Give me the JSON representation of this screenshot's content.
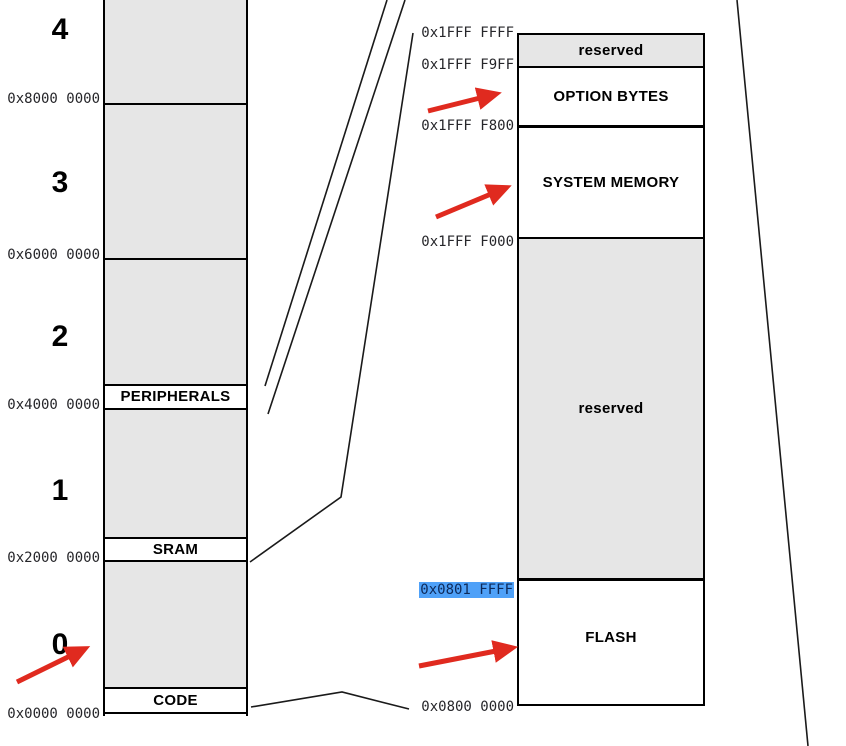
{
  "diagram": "microcontroller-memory-map",
  "left_map": {
    "region_numbers": [
      "4",
      "3",
      "2",
      "1",
      "0"
    ],
    "band_labels": {
      "peripherals": "PERIPHERALS",
      "sram": "SRAM",
      "code": "CODE"
    },
    "addresses": {
      "boundary_4": "0x8000 0000",
      "boundary_3": "0x6000 0000",
      "boundary_2": "0x4000 0000",
      "boundary_1": "0x2000 0000",
      "boundary_0": "0x0000 0000"
    }
  },
  "detail_map": {
    "region_labels": {
      "reserved_top": "reserved",
      "option_bytes": "OPTION BYTES",
      "system_memory": "SYSTEM MEMORY",
      "reserved_mid": "reserved",
      "flash": "FLASH"
    },
    "addresses": {
      "top": "0x1FFF FFFF",
      "option_bytes_top": "0x1FFF F9FF",
      "option_bytes_base": "0x1FFF F800",
      "system_memory_base": "0x1FFF F000",
      "flash_top_highlighted": "0x0801 FFFF",
      "flash_base": "0x0800 0000"
    }
  },
  "colors": {
    "region_fill": "#e6e6e6",
    "line": "#1a1a1a",
    "border": "#000000",
    "arrow_red": "#e02a1f",
    "highlight_bg": "#4fa1f8",
    "highlight_text": "#0e2a5a",
    "address_text": "#26262a"
  }
}
